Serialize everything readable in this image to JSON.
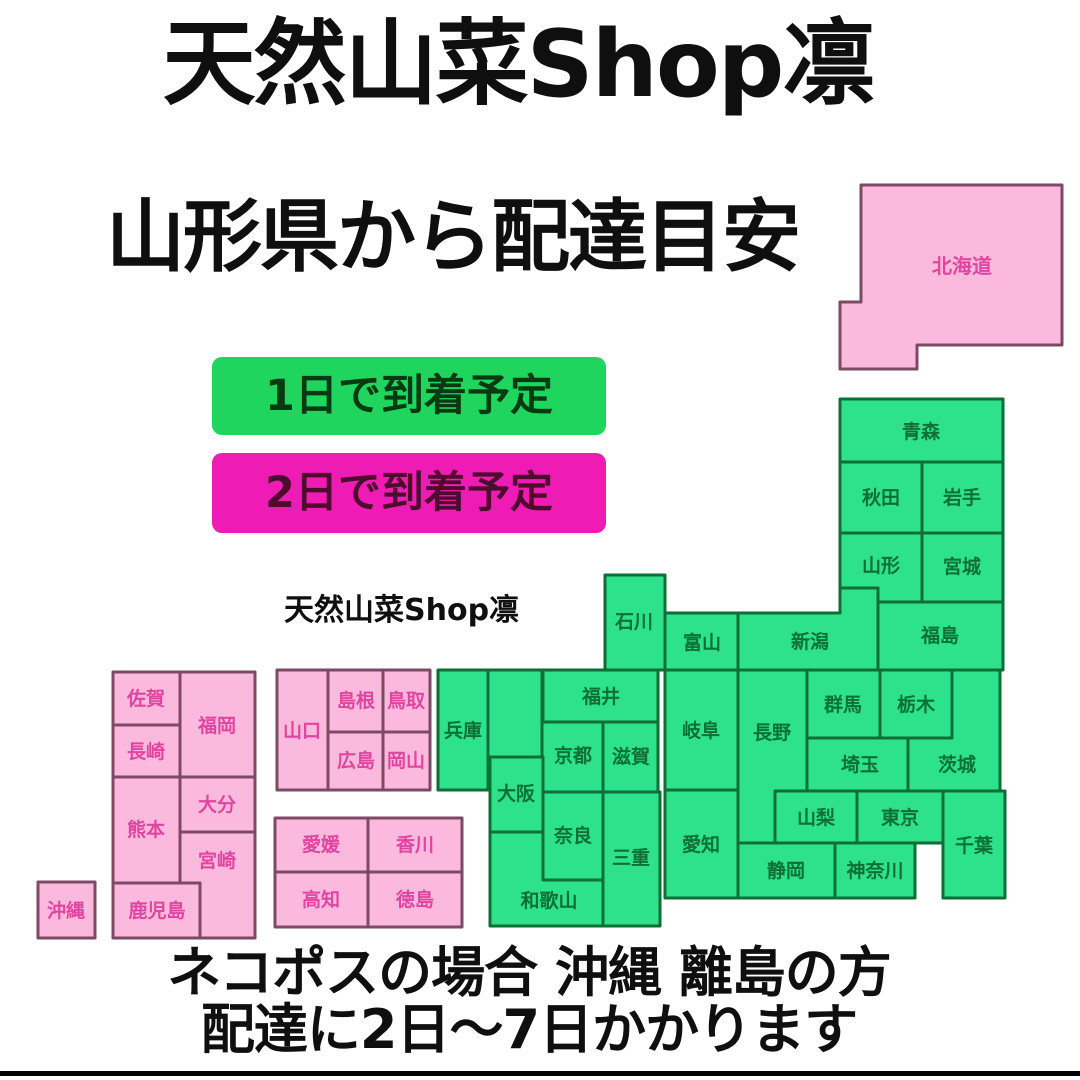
{
  "title": "天然山菜Shop凛",
  "subtitle": "山形県から配達目安",
  "watermark": "天然山菜Shop凛",
  "footer": {
    "line1": "ネコポスの場合 沖縄 離島の方",
    "line2": "配達に2日〜7日かかります"
  },
  "legend": {
    "one_day": {
      "label": "1日で到着予定",
      "fill": "#1fd55e",
      "text_color": "#053a12"
    },
    "two_day": {
      "label": "2日で到着予定",
      "fill": "#ee1cb4",
      "text_color": "#4d0c2e"
    }
  },
  "colors": {
    "background": "#ffffff",
    "heading_text": "#0f0f0f",
    "bottom_bar": "#000000",
    "one_day_fill": "#2ee28c",
    "one_day_border": "#0e6e36",
    "one_day_text": "#0d7034",
    "two_day_fill": "#fbb9de",
    "two_day_border": "#7c4a63",
    "two_day_text": "#e0459f"
  },
  "map": {
    "note": "delivery 1 = 1日で到着予定 (green), delivery 2 = 2日で到着予定 (pink)",
    "label_font_size": 19,
    "prefectures": [
      {
        "id": "hokkaido",
        "name": "北海道",
        "delivery": 2,
        "fs": 20,
        "points": [
          [
            861,
            185
          ],
          [
            1062,
            185
          ],
          [
            1062,
            345
          ],
          [
            917,
            345
          ],
          [
            917,
            369
          ],
          [
            840,
            369
          ],
          [
            840,
            302
          ],
          [
            861,
            302
          ]
        ],
        "label": [
          962,
          266
        ]
      },
      {
        "id": "aomori",
        "name": "青森",
        "delivery": 1,
        "rect": [
          840,
          399,
          163,
          63
        ],
        "label": [
          921,
          432
        ]
      },
      {
        "id": "akita",
        "name": "秋田",
        "delivery": 1,
        "rect": [
          840,
          462,
          82,
          71
        ],
        "label": [
          881,
          498
        ]
      },
      {
        "id": "iwate",
        "name": "岩手",
        "delivery": 1,
        "rect": [
          922,
          462,
          81,
          71
        ],
        "label": [
          962,
          498
        ]
      },
      {
        "id": "yamagata",
        "name": "山形",
        "delivery": 1,
        "points": [
          [
            840,
            533
          ],
          [
            922,
            533
          ],
          [
            922,
            602
          ],
          [
            878,
            602
          ],
          [
            878,
            588
          ],
          [
            840,
            588
          ]
        ],
        "label": [
          881,
          566
        ]
      },
      {
        "id": "miyagi",
        "name": "宮城",
        "delivery": 1,
        "rect": [
          922,
          533,
          81,
          69
        ],
        "label": [
          962,
          567
        ]
      },
      {
        "id": "fukushima",
        "name": "福島",
        "delivery": 1,
        "rect": [
          878,
          602,
          125,
          68
        ],
        "label": [
          940,
          636
        ]
      },
      {
        "id": "niigata",
        "name": "新潟",
        "delivery": 1,
        "points": [
          [
            738,
            613
          ],
          [
            840,
            613
          ],
          [
            840,
            588
          ],
          [
            878,
            588
          ],
          [
            878,
            670
          ],
          [
            738,
            670
          ]
        ],
        "label": [
          810,
          642
        ]
      },
      {
        "id": "toyama",
        "name": "富山",
        "delivery": 1,
        "rect": [
          665,
          613,
          73,
          57
        ],
        "label": [
          702,
          643
        ]
      },
      {
        "id": "ishikawa",
        "name": "石川",
        "delivery": 1,
        "rect": [
          605,
          575,
          60,
          95
        ],
        "label": [
          634,
          622
        ]
      },
      {
        "id": "fukui",
        "name": "福井",
        "delivery": 1,
        "rect": [
          543,
          670,
          115,
          52
        ],
        "label": [
          601,
          697
        ]
      },
      {
        "id": "gifu",
        "name": "岐阜",
        "delivery": 1,
        "rect": [
          665,
          670,
          73,
          120
        ],
        "label": [
          701,
          731
        ]
      },
      {
        "id": "nagano",
        "name": "長野",
        "delivery": 1,
        "points": [
          [
            738,
            670
          ],
          [
            807,
            670
          ],
          [
            807,
            791
          ],
          [
            775,
            791
          ],
          [
            775,
            843
          ],
          [
            738,
            843
          ]
        ],
        "label": [
          772,
          733
        ]
      },
      {
        "id": "gunma",
        "name": "群馬",
        "delivery": 1,
        "rect": [
          807,
          670,
          73,
          68
        ],
        "label": [
          843,
          705
        ]
      },
      {
        "id": "tochigi",
        "name": "栃木",
        "delivery": 1,
        "rect": [
          880,
          670,
          72,
          68
        ],
        "label": [
          916,
          705
        ]
      },
      {
        "id": "ibaraki",
        "name": "茨城",
        "delivery": 1,
        "points": [
          [
            952,
            670
          ],
          [
            1000,
            670
          ],
          [
            1000,
            791
          ],
          [
            908,
            791
          ],
          [
            908,
            738
          ],
          [
            952,
            738
          ]
        ],
        "label": [
          957,
          765
        ]
      },
      {
        "id": "saitama",
        "name": "埼玉",
        "delivery": 1,
        "rect": [
          807,
          738,
          101,
          53
        ],
        "label": [
          860,
          765
        ]
      },
      {
        "id": "yamanashi",
        "name": "山梨",
        "delivery": 1,
        "rect": [
          775,
          791,
          82,
          52
        ],
        "label": [
          816,
          818
        ]
      },
      {
        "id": "tokyo",
        "name": "東京",
        "delivery": 1,
        "rect": [
          857,
          791,
          86,
          52
        ],
        "label": [
          900,
          818
        ]
      },
      {
        "id": "chiba",
        "name": "千葉",
        "delivery": 1,
        "rect": [
          943,
          791,
          62,
          107
        ],
        "label": [
          974,
          846
        ]
      },
      {
        "id": "kanagawa",
        "name": "神奈川",
        "delivery": 1,
        "rect": [
          835,
          843,
          80,
          55
        ],
        "label": [
          875,
          871
        ]
      },
      {
        "id": "shizuoka",
        "name": "静岡",
        "delivery": 1,
        "rect": [
          738,
          843,
          97,
          55
        ],
        "label": [
          786,
          871
        ]
      },
      {
        "id": "aichi",
        "name": "愛知",
        "delivery": 1,
        "rect": [
          665,
          790,
          73,
          108
        ],
        "label": [
          701,
          845
        ]
      },
      {
        "id": "hyogo",
        "name": "兵庫",
        "delivery": 1,
        "rect": [
          438,
          670,
          50,
          120
        ],
        "label": [
          463,
          731
        ]
      },
      {
        "id": "kyoto-north",
        "name": "",
        "delivery": 1,
        "rect": [
          488,
          670,
          54,
          87
        ]
      },
      {
        "id": "kyoto",
        "name": "京都",
        "delivery": 1,
        "rect": [
          542,
          722,
          61,
          70
        ],
        "label": [
          573,
          756
        ]
      },
      {
        "id": "shiga",
        "name": "滋賀",
        "delivery": 1,
        "rect": [
          603,
          722,
          55,
          70
        ],
        "label": [
          631,
          757
        ]
      },
      {
        "id": "osaka",
        "name": "大阪",
        "delivery": 1,
        "rect": [
          490,
          757,
          53,
          75
        ],
        "label": [
          516,
          794
        ]
      },
      {
        "id": "nara",
        "name": "奈良",
        "delivery": 1,
        "rect": [
          543,
          792,
          60,
          88
        ],
        "label": [
          573,
          836
        ]
      },
      {
        "id": "mie",
        "name": "三重",
        "delivery": 1,
        "rect": [
          603,
          792,
          57,
          134
        ],
        "label": [
          631,
          858
        ]
      },
      {
        "id": "wakayama",
        "name": "和歌山",
        "delivery": 1,
        "points": [
          [
            490,
            832
          ],
          [
            543,
            832
          ],
          [
            543,
            880
          ],
          [
            603,
            880
          ],
          [
            603,
            926
          ],
          [
            490,
            926
          ]
        ],
        "label": [
          549,
          901
        ]
      },
      {
        "id": "yamaguchi",
        "name": "山口",
        "delivery": 2,
        "rect": [
          277,
          670,
          51,
          120
        ],
        "label": [
          302,
          731
        ]
      },
      {
        "id": "shimane",
        "name": "島根",
        "delivery": 2,
        "rect": [
          328,
          670,
          55,
          62
        ],
        "label": [
          356,
          701
        ]
      },
      {
        "id": "tottori",
        "name": "鳥取",
        "delivery": 2,
        "rect": [
          383,
          670,
          47,
          62
        ],
        "label": [
          406,
          701
        ]
      },
      {
        "id": "hiroshima",
        "name": "広島",
        "delivery": 2,
        "rect": [
          328,
          732,
          55,
          58
        ],
        "label": [
          356,
          761
        ]
      },
      {
        "id": "okayama",
        "name": "岡山",
        "delivery": 2,
        "rect": [
          383,
          732,
          47,
          58
        ],
        "label": [
          406,
          761
        ]
      },
      {
        "id": "ehime",
        "name": "愛媛",
        "delivery": 2,
        "rect": [
          275,
          818,
          93,
          54
        ],
        "label": [
          321,
          845
        ]
      },
      {
        "id": "kagawa",
        "name": "香川",
        "delivery": 2,
        "rect": [
          368,
          818,
          94,
          54
        ],
        "label": [
          415,
          845
        ]
      },
      {
        "id": "kochi",
        "name": "高知",
        "delivery": 2,
        "rect": [
          275,
          872,
          93,
          55
        ],
        "label": [
          321,
          900
        ]
      },
      {
        "id": "tokushima",
        "name": "徳島",
        "delivery": 2,
        "rect": [
          368,
          872,
          94,
          55
        ],
        "label": [
          415,
          900
        ]
      },
      {
        "id": "saga",
        "name": "佐賀",
        "delivery": 2,
        "rect": [
          113,
          672,
          67,
          53
        ],
        "label": [
          146,
          699
        ]
      },
      {
        "id": "fukuoka",
        "name": "福岡",
        "delivery": 2,
        "rect": [
          180,
          672,
          75,
          105
        ],
        "label": [
          217,
          726
        ]
      },
      {
        "id": "nagasaki",
        "name": "長崎",
        "delivery": 2,
        "rect": [
          113,
          725,
          67,
          52
        ],
        "label": [
          146,
          752
        ]
      },
      {
        "id": "kumamoto",
        "name": "熊本",
        "delivery": 2,
        "rect": [
          113,
          777,
          67,
          106
        ],
        "label": [
          146,
          830
        ]
      },
      {
        "id": "oita",
        "name": "大分",
        "delivery": 2,
        "rect": [
          180,
          777,
          75,
          55
        ],
        "label": [
          217,
          805
        ]
      },
      {
        "id": "miyazaki",
        "name": "宮崎",
        "delivery": 2,
        "points": [
          [
            180,
            832
          ],
          [
            255,
            832
          ],
          [
            255,
            938
          ],
          [
            200,
            938
          ],
          [
            200,
            883
          ],
          [
            180,
            883
          ]
        ],
        "label": [
          217,
          861
        ]
      },
      {
        "id": "kagoshima",
        "name": "鹿児島",
        "delivery": 2,
        "rect": [
          113,
          883,
          87,
          55
        ],
        "label": [
          157,
          911
        ]
      },
      {
        "id": "okinawa",
        "name": "沖縄",
        "delivery": 2,
        "rect": [
          38,
          882,
          57,
          56
        ],
        "label": [
          66,
          911
        ]
      }
    ]
  }
}
